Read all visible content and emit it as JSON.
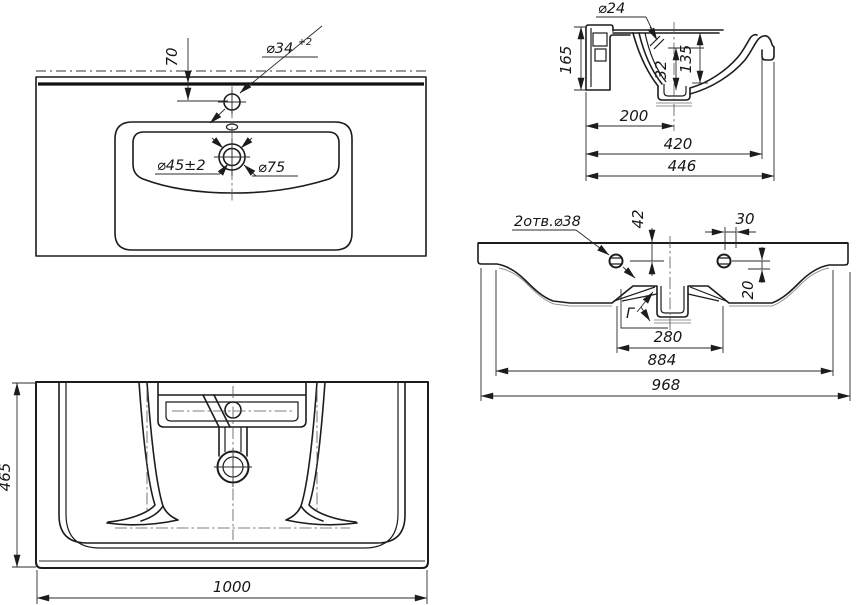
{
  "drawing": {
    "background_color": "#ffffff",
    "line_color": "#1c1c1c",
    "views": {
      "top_view": {
        "dims": {
          "faucet_offset": "70",
          "faucet_hole_d": "⌀34",
          "faucet_hole_tol": "+2",
          "drain_hole_d": "⌀45±2",
          "drain_recess_d": "⌀75"
        }
      },
      "side_section": {
        "dims": {
          "overflow_hole_d": "⌀24",
          "height": "165",
          "overflow_drop": "32",
          "basin_depth": "135",
          "drain_offset": "200",
          "depth_inner": "420",
          "depth_total": "446"
        }
      },
      "rear_view": {
        "dims": {
          "mount_holes": "2отв.⌀38",
          "hole_down_offset": "42",
          "hole_side_offset": "30",
          "hole_drop": "20",
          "detail_mark": "Г",
          "recess_width": "280",
          "mount_span": "884",
          "body_width": "968"
        }
      },
      "bottom_view": {
        "dims": {
          "depth": "465",
          "width": "1000"
        }
      }
    }
  }
}
